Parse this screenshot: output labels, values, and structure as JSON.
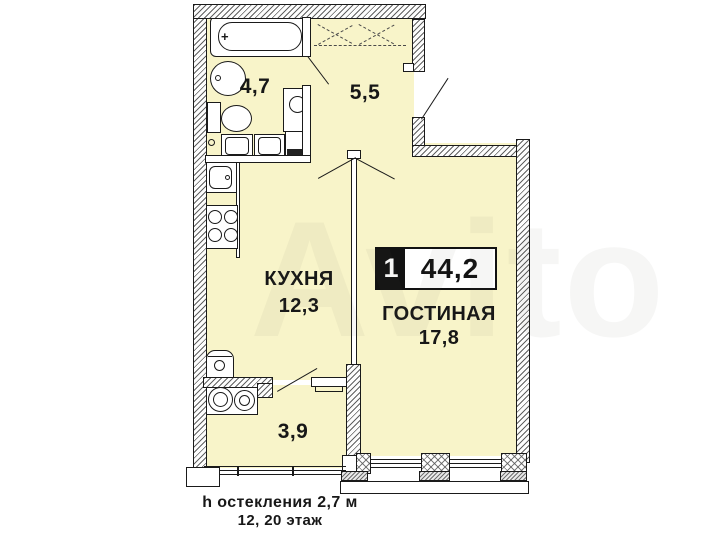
{
  "watermark": {
    "text": "Avito"
  },
  "badge": {
    "rooms_count": "1",
    "total_area": "44,2"
  },
  "rooms": {
    "bathroom": {
      "area": "4,7"
    },
    "hallway": {
      "area": "5,5"
    },
    "kitchen": {
      "name": "КУХНЯ",
      "area": "12,3"
    },
    "living_room": {
      "name": "ГОСТИНАЯ",
      "area": "17,8"
    },
    "loggia": {
      "area": "3,9"
    }
  },
  "footer": {
    "glazing_height": "h остекления 2,7 м",
    "floor_info": "12, 20 этаж"
  },
  "colors": {
    "floor_fill": "#F8F4C9",
    "wall_line": "#1A1A1A",
    "badge_black": "#121212"
  }
}
